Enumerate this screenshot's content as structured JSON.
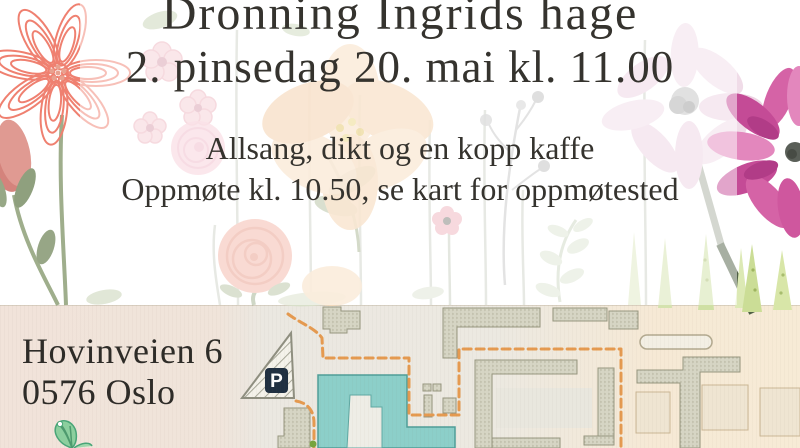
{
  "poster": {
    "title": "Dronning Ingrids hage",
    "date_line": "2. pinsedag 20. mai kl. 11.00",
    "description_line1": "Allsang, dikt og en kopp kaffe",
    "description_line2": "Oppmøte kl. 10.50, se kart for oppmøtested",
    "text_color": "#35332e"
  },
  "location": {
    "address_line1": "Hovinveien 6",
    "address_line2": "0576 Oslo"
  },
  "map": {
    "parking_label": "P",
    "colors": {
      "route": "#e59a50",
      "highlight_building": "#8ccfc9",
      "highlight_building_border": "#4f9e98",
      "building": "#d6d5c4",
      "building_border": "#97967f",
      "parking_sign_bg": "#203041",
      "bg_left": "#f1e3da",
      "bg_middle": "#ebe8e1",
      "bg_right": "#f6e9d5"
    }
  },
  "decorations": {
    "items": [
      "coral-line-flower",
      "pink-bud",
      "pink-blossoms",
      "peach-flower",
      "rose-small",
      "rose",
      "berry-sprig",
      "olive-leaves",
      "leaf-sprig",
      "pale-daisy",
      "magenta-daisy",
      "grass",
      "butterfly"
    ]
  }
}
